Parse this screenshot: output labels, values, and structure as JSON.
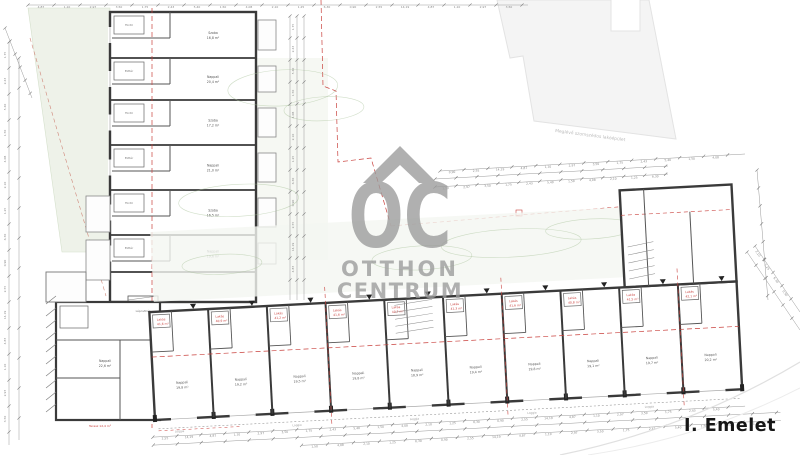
{
  "page": {
    "floor_label": "I. Emelet"
  },
  "watermark": {
    "monogram": "OC",
    "brand_top": "OTTHON",
    "brand_bottom": "CENTRUM"
  },
  "neighbor_label": "Meglévő szomszédos lakóépület",
  "colors": {
    "wall": "#3a3a3a",
    "inner_wall": "#555555",
    "red": "#c9413d",
    "red_soft": "#cf8578",
    "dim": "#9a9a9a",
    "green_fill": "#eef2e9",
    "green_line": "#a9c29a",
    "green_dark": "#4e7d46",
    "neighbor_fill": "#f4f4f4",
    "neighbor_stroke": "#e3e3e3",
    "watermark": "#9b9b9b",
    "title": "#161616"
  },
  "left_wing_units": [
    {
      "room": "Szoba",
      "area": "16,8 m²",
      "service": "Fürdő"
    },
    {
      "room": "Nappali",
      "area": "20,4 m²",
      "service": "Előtér"
    },
    {
      "room": "Szoba",
      "area": "17,2 m²",
      "service": "Fürdő"
    },
    {
      "room": "Nappali",
      "area": "21,0 m²",
      "service": "Előtér"
    },
    {
      "room": "Szoba",
      "area": "16,5 m²",
      "service": "Fürdő"
    },
    {
      "room": "Nappali",
      "area": "19,6 m²",
      "service": "Előtér"
    }
  ],
  "corner_unit": {
    "room": "Nappali",
    "area": "22,6 m²",
    "terrace": "Terasz 12,4 m²",
    "stair": "Lépcsőház"
  },
  "bottom_wing_units": [
    {
      "unit": "Lakás",
      "unit_area": "41,6 m²",
      "room": "Nappali",
      "room_area": "19,8 m²"
    },
    {
      "unit": "Lakás",
      "unit_area": "40,9 m²",
      "room": "Nappali",
      "room_area": "19,2 m²"
    },
    {
      "unit": "Lakás",
      "unit_area": "41,2 m²",
      "room": "Nappali",
      "room_area": "19,5 m²"
    },
    {
      "unit": "Lakás",
      "unit_area": "41,6 m²",
      "room": "Nappali",
      "room_area": "19,8 m²"
    },
    {
      "unit": "Lakás",
      "unit_area": "40,7 m²",
      "room": "Nappali",
      "room_area": "18,9 m²"
    },
    {
      "unit": "Lakás",
      "unit_area": "41,3 m²",
      "room": "Nappali",
      "room_area": "19,4 m²"
    },
    {
      "unit": "Lakás",
      "unit_area": "41,6 m²",
      "room": "Nappali",
      "room_area": "19,8 m²"
    },
    {
      "unit": "Lakás",
      "unit_area": "40,8 m²",
      "room": "Nappali",
      "room_area": "19,1 m²"
    },
    {
      "unit": "Lakás",
      "unit_area": "41,5 m²",
      "room": "Nappali",
      "room_area": "19,7 m²"
    },
    {
      "unit": "Lakás",
      "unit_area": "42,1 m²",
      "room": "Nappali",
      "room_area": "20,2 m²"
    }
  ],
  "loggia_label": "Loggia",
  "dims": {
    "numbers": [
      "4,87",
      "1,10",
      "2,97",
      "3,50",
      "1,75",
      "2,43",
      "5,40",
      "1,50",
      "4,08",
      "2,10",
      "1,25",
      "6,30",
      "0,90",
      "2,55",
      "14,19"
    ]
  }
}
